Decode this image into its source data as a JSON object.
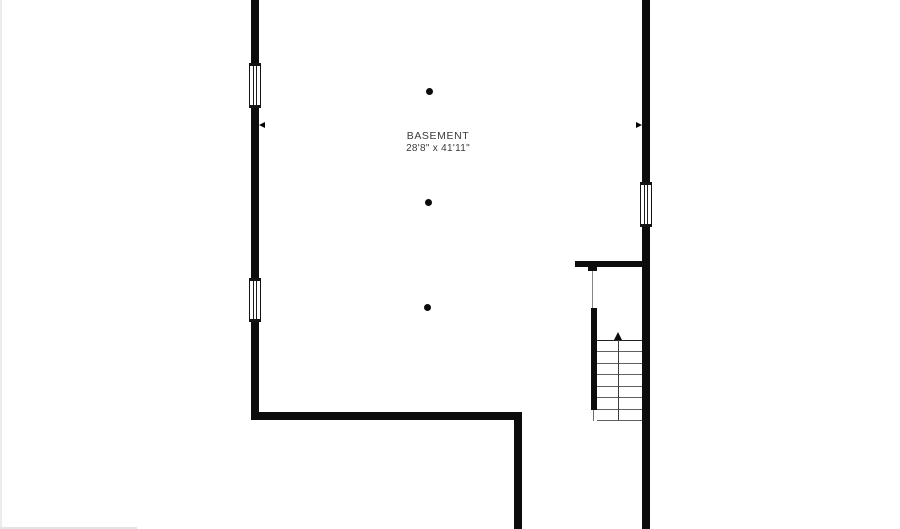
{
  "floorplan": {
    "room": {
      "label": "BASEMENT",
      "dimensions": "28'8\" x 41'11\""
    },
    "stairs": {
      "treads": 8,
      "direction": "up"
    },
    "support_columns": 3,
    "windows": 3,
    "colors": {
      "wall": "#0c0c0c",
      "background": "#ffffff",
      "tread_line": "#606060",
      "first_tread_line": "#222222",
      "label_text": "#3a3a3a"
    }
  }
}
